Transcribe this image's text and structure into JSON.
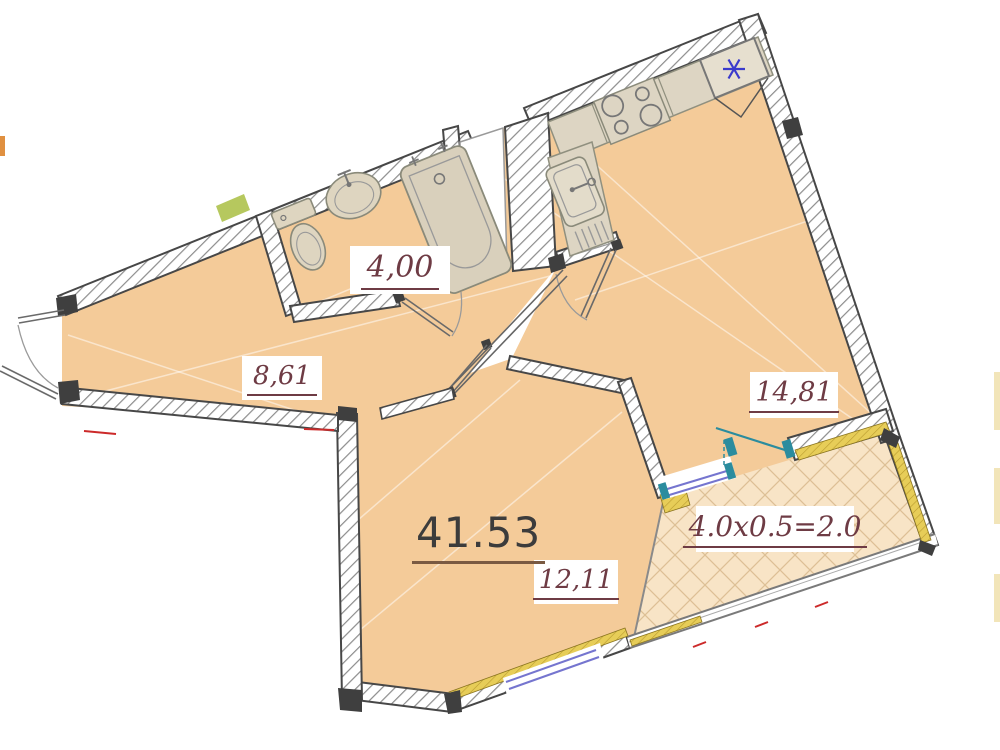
{
  "document": {
    "type": "apartment floor plan drawing",
    "total_area_label": "41.53"
  },
  "rooms": [
    {
      "id": "bathroom",
      "area_label": "4,00"
    },
    {
      "id": "hallway",
      "area_label": "8,61"
    },
    {
      "id": "kitchen-living-room",
      "area_label": "14,81"
    },
    {
      "id": "bedroom",
      "area_label": "12,11"
    },
    {
      "id": "balcony",
      "area_label": "4.0x0.5=2.0"
    }
  ],
  "fixtures": [
    "toilet",
    "washbasin",
    "bathtub",
    "kitchen-sink",
    "stove-four-burners",
    "refrigerator-with-snowflake"
  ],
  "colors": {
    "floor_fill": "#f4cb99",
    "balcony_fill": "#f8e4c6",
    "wall_edge": "#474747",
    "wall_hatch": "#8c8c8c",
    "counter_fill": "#ddd5c3",
    "fixture_fill": "#ded5c0",
    "insulation_yellow": "#e0c24e",
    "window_blue": "#7575cf",
    "balcony_door_teal": "#2b8c9e",
    "label_maroon": "#6e3b44",
    "total_label_gray": "#3c3c3c",
    "snowflake_blue": "#3a3acc",
    "accent_red": "#cc2a2a",
    "green_patch": "#b6c85e"
  }
}
